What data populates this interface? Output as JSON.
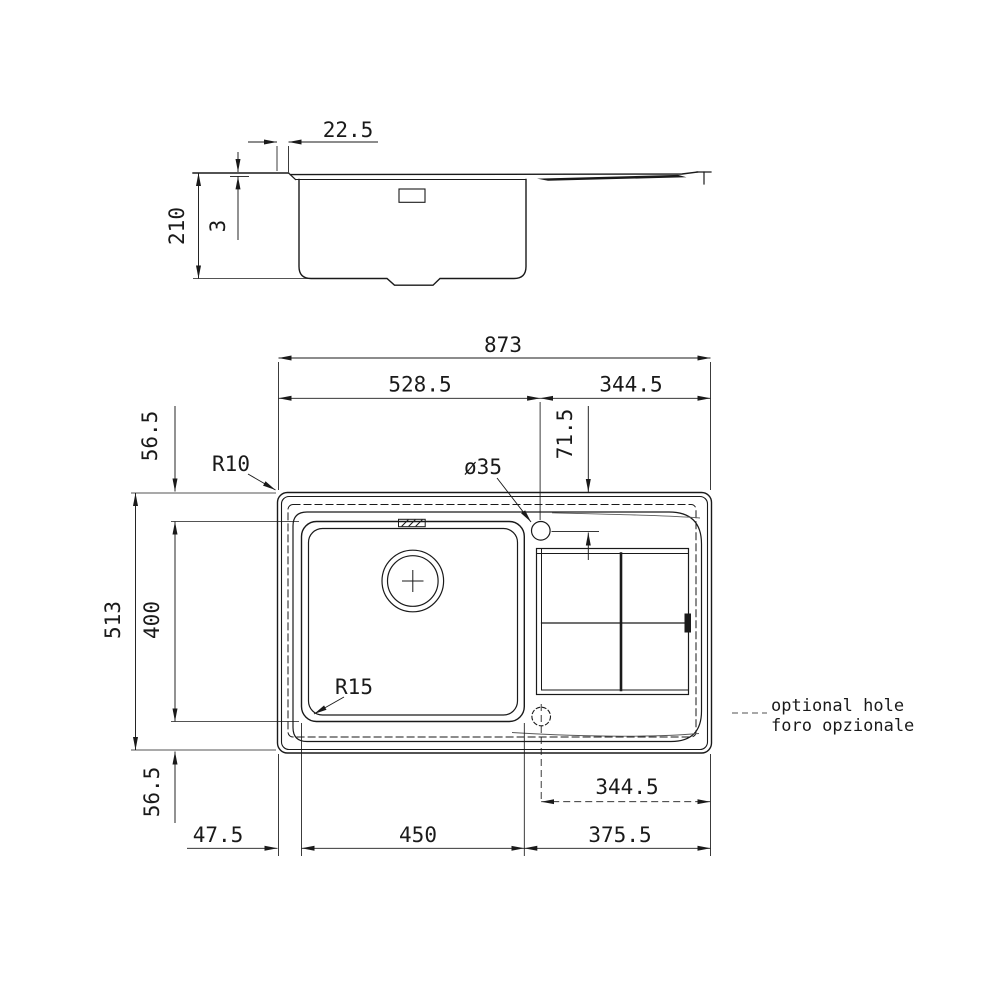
{
  "drawing_title": "sink technical drawing",
  "side_view": {
    "rim_width": "22.5",
    "overall_height": "210",
    "rim_thickness": "3"
  },
  "plan_view": {
    "overall_width": "873",
    "left_edge_to_tap": "528.5",
    "tap_to_right_edge": "344.5",
    "top_margin": "56.5",
    "tap_center_offset": "71.5",
    "overall_depth": "513",
    "bowl_depth": "400",
    "outer_corner_radius": "R10",
    "tap_hole_diameter": "ø35",
    "bowl_corner_radius": "R15",
    "optional_hole_to_right_edge": "344.5",
    "bottom_margin": "56.5",
    "left_margin": "47.5",
    "bowl_width": "450",
    "right_margin": "375.5"
  },
  "legend": {
    "line1": "optional hole",
    "line2": "foro opzionale"
  },
  "colors": {
    "line_color": "#1a1a1a",
    "background": "#ffffff"
  }
}
